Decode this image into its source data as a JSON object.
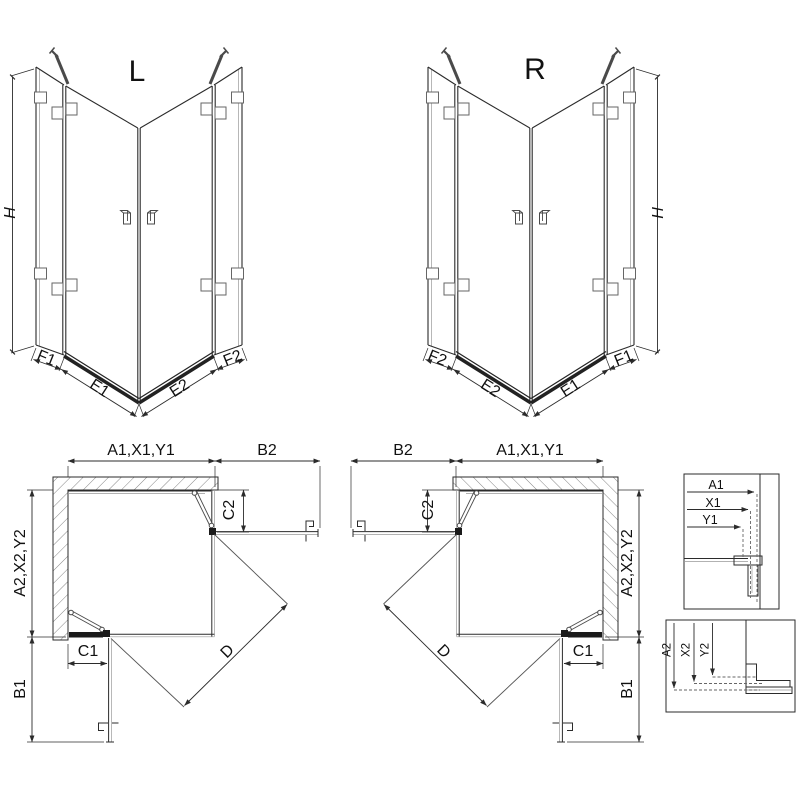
{
  "drawing": {
    "colors": {
      "line": "#2b2b2b",
      "thin_line": "#999999",
      "hatch": "#777777",
      "fill_dark": "#1a1a1a",
      "background": "#ffffff"
    },
    "iso_left": {
      "title": "L",
      "dim_h": "H",
      "dim_f1": "F1",
      "dim_e1": "E1",
      "dim_e2": "E2",
      "dim_f2": "F2"
    },
    "iso_right": {
      "title": "R",
      "dim_h": "H",
      "dim_f1": "F1",
      "dim_e1": "E1",
      "dim_e2": "E2",
      "dim_f2": "F2"
    },
    "plan_left": {
      "dim_width": "A1,X1,Y1",
      "dim_b2": "B2",
      "dim_depth": "A2,X2,Y2",
      "dim_c1": "C1",
      "dim_c2": "C2",
      "dim_b1": "B1",
      "dim_d": "D"
    },
    "plan_right": {
      "dim_width": "A1,X1,Y1",
      "dim_b2": "B2",
      "dim_depth": "A2,X2,Y2",
      "dim_c1": "C1",
      "dim_c2": "C2",
      "dim_b1": "B1",
      "dim_d": "D"
    },
    "detail_top": {
      "dims": [
        "A1",
        "X1",
        "Y1"
      ]
    },
    "detail_bottom": {
      "dims": [
        "A2",
        "X2",
        "Y2"
      ]
    }
  }
}
